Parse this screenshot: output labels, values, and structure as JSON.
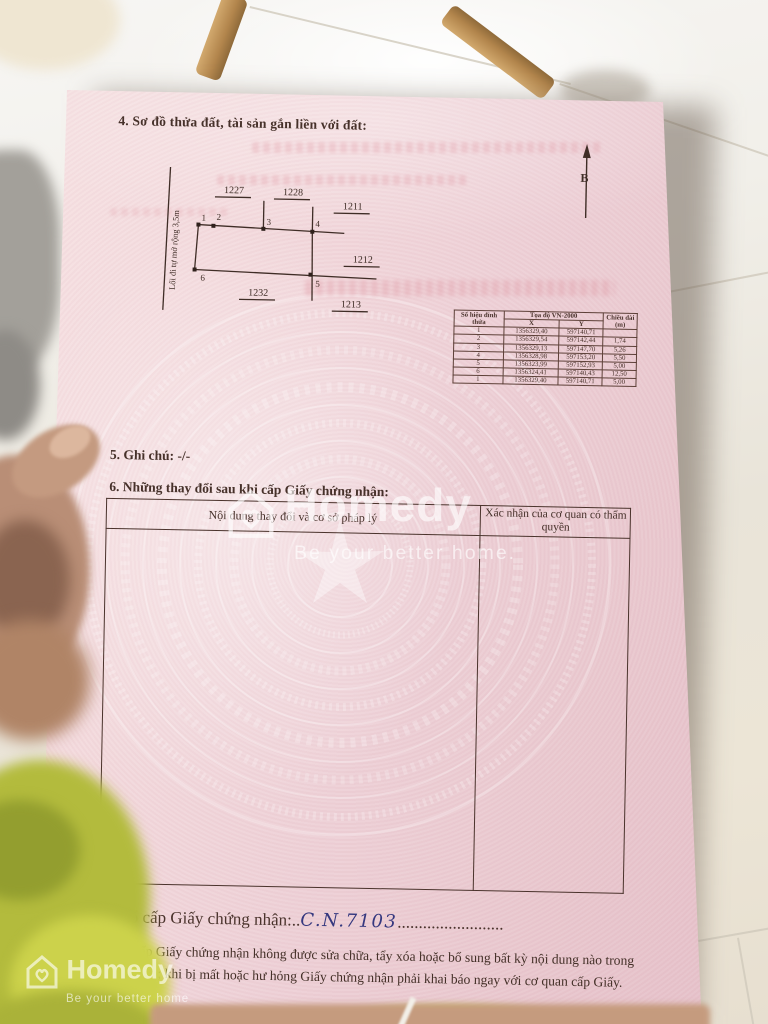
{
  "watermark": {
    "brand": "Homedy",
    "tagline_center": "Be your better home.",
    "tagline_corner": "Be your better home"
  },
  "document": {
    "section4_title": "4. Sơ đồ thửa đất, tài sản gắn liền với đất:",
    "north_label": "B",
    "diagram": {
      "road_label": "Lối đi tự mở rộng 3,5m",
      "parcels": [
        "1227",
        "1228",
        "1211",
        "1212",
        "1232",
        "1213"
      ],
      "vertices": [
        "1",
        "2",
        "3",
        "4",
        "5",
        "6"
      ]
    },
    "coord_table": {
      "col_vertex": "Số hiệu đỉnh thửa",
      "col_coords": "Tọa độ VN-2000",
      "col_x": "X",
      "col_y": "Y",
      "col_length": "Chiều dài (m)",
      "rows": [
        [
          "1",
          "1356329,40",
          "597140,71",
          ""
        ],
        [
          "2",
          "1356329,54",
          "597142,44",
          "1,74"
        ],
        [
          "3",
          "1356329,13",
          "597147,70",
          "5,26"
        ],
        [
          "4",
          "1356328,98",
          "597153,20",
          "5,50"
        ],
        [
          "5",
          "1356323,99",
          "597152,93",
          "5,00"
        ],
        [
          "6",
          "1356324,41",
          "597140,43",
          "12,50"
        ],
        [
          "1",
          "1356329,40",
          "597140,71",
          "5,00"
        ]
      ]
    },
    "section5_line": "5. Ghi chú: -/-",
    "section6_title": "6. Những thay đổi sau khi cấp Giấy chứng nhận:",
    "changes_table": {
      "col_content": "Nội dung thay đổi và cơ sở pháp lý",
      "col_confirm": "Xác nhận của cơ quan có thẩm quyền"
    },
    "issue_label": "Số vào sổ cấp Giấy chứng nhận:..",
    "issue_number": "C.N.7103",
    "issue_dots": ".........................",
    "notice_line1": "Người được cấp Giấy chứng nhận không được sửa chữa, tẩy xóa hoặc bổ sung bất kỳ nội dung nào trong",
    "notice_line2": "Giấy chứng nhận; khi bị mất hoặc hư hỏng Giấy chứng nhận phải khai báo ngay với cơ quan cấp Giấy."
  }
}
